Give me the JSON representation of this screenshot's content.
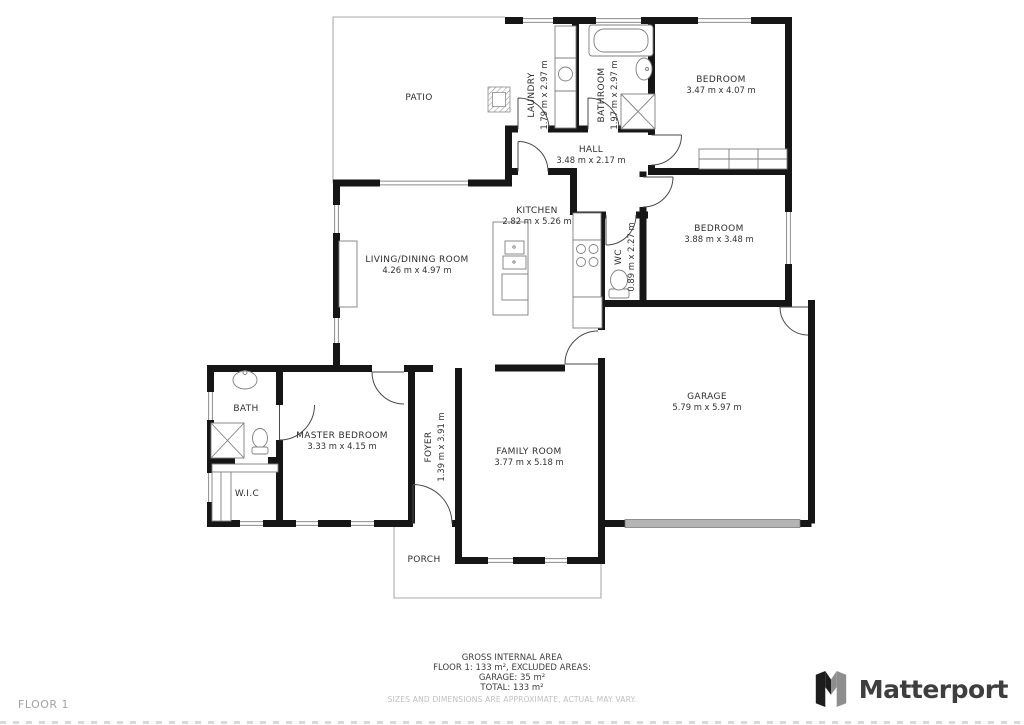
{
  "plan": {
    "rooms": [
      {
        "id": "patio",
        "label": "PATIO",
        "dims": ""
      },
      {
        "id": "laundry",
        "label": "LAUNDRY",
        "dims": "1.79 m x 2.97 m"
      },
      {
        "id": "bathroom",
        "label": "BATHROOM",
        "dims": "1.97 m x 2.97 m"
      },
      {
        "id": "bedroom-top",
        "label": "BEDROOM",
        "dims": "3.47 m x 4.07 m"
      },
      {
        "id": "hall",
        "label": "HALL",
        "dims": "3.48 m x 2.17 m"
      },
      {
        "id": "kitchen",
        "label": "KITCHEN",
        "dims": "2.82 m x 5.26 m"
      },
      {
        "id": "living-dining",
        "label": "LIVING/DINING ROOM",
        "dims": "4.26 m x 4.97 m"
      },
      {
        "id": "wc",
        "label": "WC",
        "dims": "0.89 m x 2.27 m"
      },
      {
        "id": "bedroom-mid",
        "label": "BEDROOM",
        "dims": "3.88 m x 3.48 m"
      },
      {
        "id": "garage",
        "label": "GARAGE",
        "dims": "5.79 m x 5.97 m"
      },
      {
        "id": "bath",
        "label": "BATH",
        "dims": ""
      },
      {
        "id": "master-bedroom",
        "label": "MASTER BEDROOM",
        "dims": "3.33 m x 4.15 m"
      },
      {
        "id": "wic",
        "label": "W.I.C",
        "dims": ""
      },
      {
        "id": "foyer",
        "label": "FOYER",
        "dims": "1.39 m x 3.91 m"
      },
      {
        "id": "family-room",
        "label": "FAMILY ROOM",
        "dims": "3.77 m x 5.18 m"
      },
      {
        "id": "porch",
        "label": "PORCH",
        "dims": ""
      }
    ]
  },
  "footer": {
    "floor_label": "FLOOR 1",
    "summary": {
      "title": "GROSS INTERNAL AREA",
      "line1": "FLOOR 1: 133 m², EXCLUDED AREAS:",
      "line2": "GARAGE: 35 m²",
      "line3": "TOTAL: 133 m²",
      "disclaimer": "SIZES AND DIMENSIONS ARE APPROXIMATE, ACTUAL MAY VARY."
    },
    "brand": {
      "name": "Matterport"
    }
  },
  "colors": {
    "wall": "#161616",
    "window_line": "#8c8c8c",
    "thin_outline": "#ababab",
    "brand_dark": "#1d1d1d",
    "brand_gray": "#8e8e8e",
    "summary_text": "#3d3d3d",
    "muted_text": "#c0c0c0",
    "floor_label_text": "#a2a2a2"
  }
}
